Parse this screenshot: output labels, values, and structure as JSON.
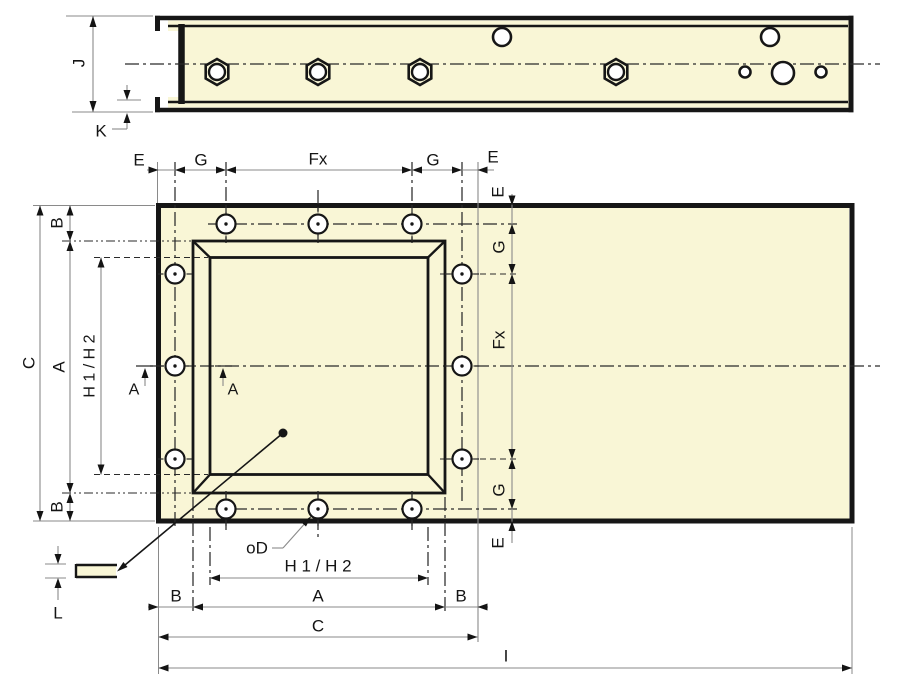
{
  "drawing": {
    "colors": {
      "background": "#ffffff",
      "part_fill": "#f9f6d6",
      "edge": "#161616",
      "dim_line": "#8a8a8a",
      "center_line": "#2a2a2a",
      "text": "#141414"
    },
    "side_view": {
      "height_label": "J",
      "lip_label": "K"
    },
    "plan_view": {
      "top_chain": {
        "e_left": "E",
        "g_left": "G",
        "fx": "Fx",
        "g_right": "G",
        "e_right": "E"
      },
      "right_chain": {
        "e_top": "E",
        "g_top": "G",
        "fx": "Fx",
        "g_bottom": "G",
        "e_bottom": "E"
      },
      "left_chain": {
        "b_top": "B",
        "a": "A",
        "b_bottom": "B",
        "c": "C",
        "h1_h2": "H 1 / H 2"
      },
      "section_marks": {
        "left": "A",
        "right": "A"
      },
      "bottom_chain": {
        "hole_diameter": "oD",
        "h1_h2": "H 1 / H 2",
        "b_left": "B",
        "a": "A",
        "b_right": "B",
        "c": "C",
        "i": "I"
      },
      "thickness_label": "L"
    }
  }
}
